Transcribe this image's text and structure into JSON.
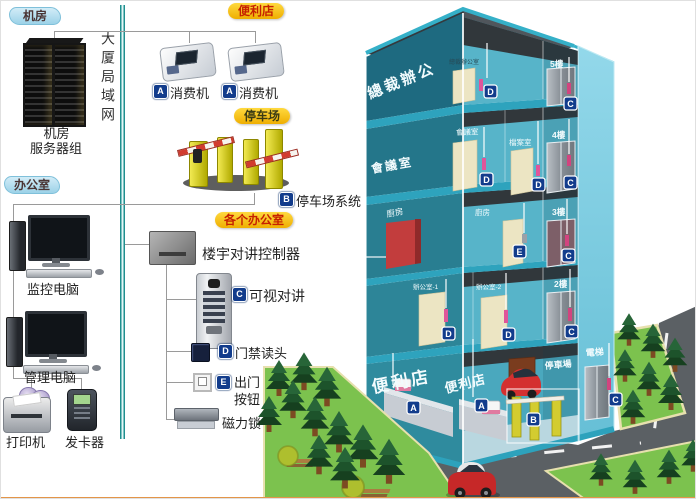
{
  "badges": {
    "a": "A",
    "b": "B",
    "c": "C",
    "d": "D",
    "e": "E"
  },
  "panel": {
    "tab_server_room": "机房",
    "tab_office": "办公室",
    "tab_store": "便利店",
    "tab_parking": "停车场",
    "tab_offices": "各个办公室",
    "lan": "大厦局域网",
    "server_caption_line1": "机房",
    "server_caption_line2": "服务器组",
    "monitor_pc": "监控电脑",
    "admin_pc": "管理电脑",
    "printer": "打印机",
    "card_writer": "发卡器",
    "pos_machine_1": "消费机",
    "pos_machine_2": "消费机",
    "parking_system": "停车场系统",
    "intercom_controller": "楼宇对讲控制器",
    "video_intercom": "可视对讲",
    "door_reader": "门禁读头",
    "exit_button_line1": "出门",
    "exit_button_line2": "按钮",
    "magnetic_lock": "磁力锁"
  },
  "building": {
    "f5_wall": "總裁辦公",
    "f5_room": "總裁辦公室",
    "f5_tag": "5樓",
    "f4_wall": "會議室",
    "f4_room1": "會議室",
    "f4_room2": "檔案室",
    "f4_tag": "4樓",
    "f3_wall": "廚房",
    "f3_room": "廚房",
    "f3_tag": "3樓",
    "f2_room1": "辦公室-1",
    "f2_room2": "辦公室-2",
    "f2_tag": "2樓",
    "g_wall": "便利店",
    "g_room": "便利店",
    "g_parking": "停車場",
    "g_elevator": "電梯"
  }
}
